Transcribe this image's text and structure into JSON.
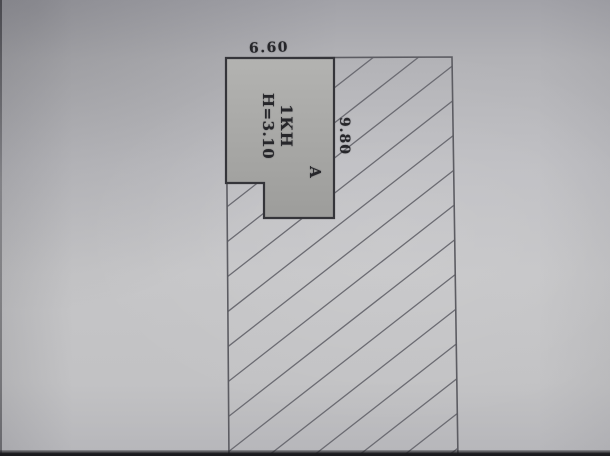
{
  "figure": {
    "dim_width_label": "6.60",
    "dim_length_label": "9.80",
    "room_name": "1КН",
    "room_height": "Н=3.10",
    "section_label": "А"
  },
  "colors": {
    "paper": "#c2c2c6",
    "room_fill_top": "#b3b3b1",
    "room_fill_bottom": "#9d9d9b",
    "room_outline": "#35353a",
    "boundary_line": "#5c5c62",
    "hatch_line": "#6b6b72",
    "text": "#26262a"
  }
}
